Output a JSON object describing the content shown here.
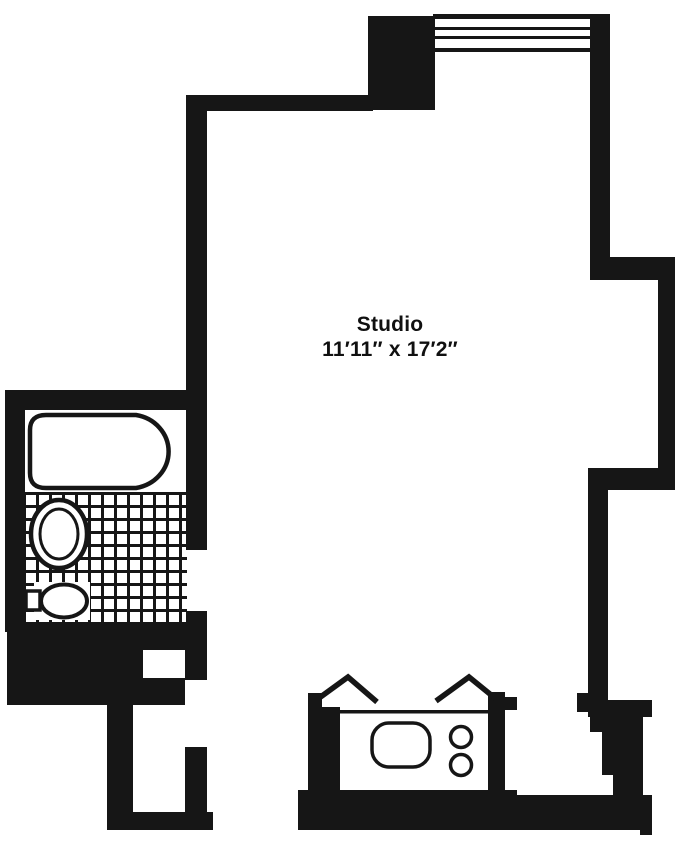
{
  "colors": {
    "walls": "#161616",
    "background": "#ffffff"
  },
  "room": {
    "name": "Studio",
    "dimensions": "11′11″ x 17′2″"
  },
  "fixtures": {
    "bathroom": [
      "bathtub",
      "toilet",
      "sink",
      "tiled-floor"
    ],
    "kitchen": [
      "counter",
      "kitchen-sink",
      "stove-burners",
      "door-swing-left",
      "door-swing-right"
    ],
    "architecture": [
      "window",
      "entry-door-opening",
      "bathroom-door-opening",
      "pipe-chase"
    ]
  }
}
